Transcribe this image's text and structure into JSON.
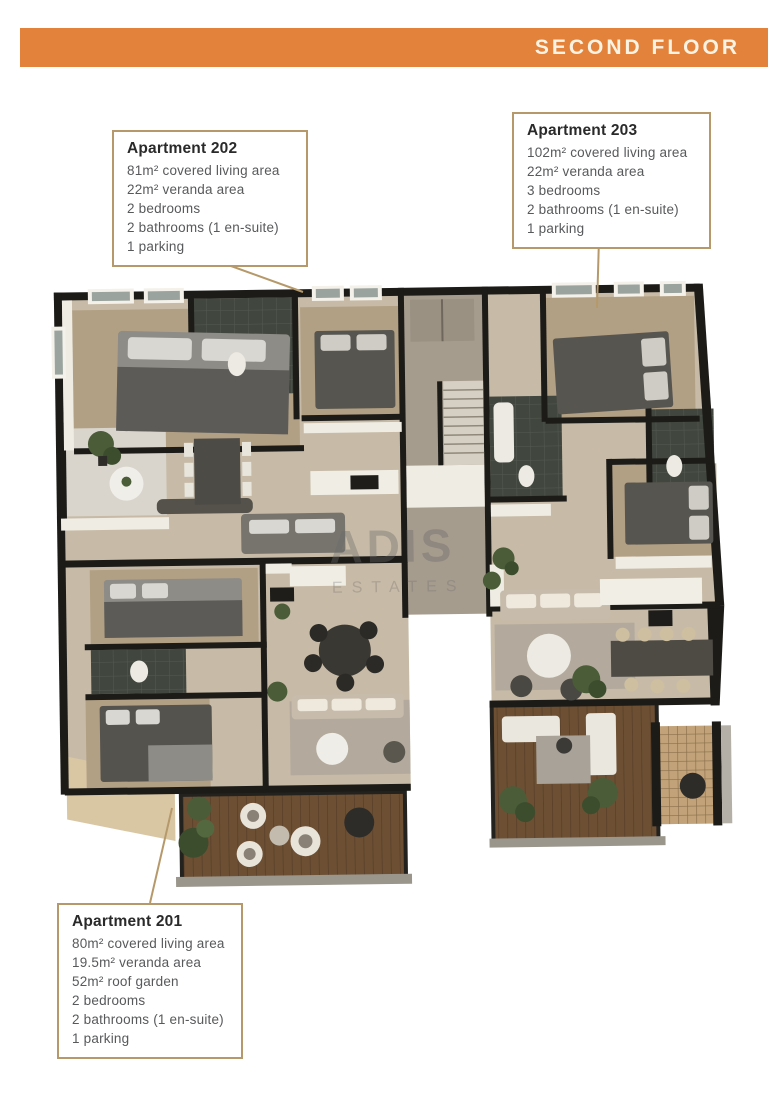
{
  "header": {
    "title": "SECOND FLOOR"
  },
  "watermark": {
    "line1": "ADIS",
    "line2": "ESTATES"
  },
  "apartments": [
    {
      "id": "202",
      "title": "Apartment 202",
      "specs": [
        "81m² covered living area",
        "22m² veranda area",
        "2 bedrooms",
        "2 bathrooms (1 en-suite)",
        "1 parking"
      ]
    },
    {
      "id": "203",
      "title": "Apartment 203",
      "specs": [
        "102m² covered living area",
        "22m² veranda area",
        "3 bedrooms",
        "2 bathrooms (1 en-suite)",
        "1 parking"
      ]
    },
    {
      "id": "201",
      "title": "Apartment 201",
      "specs": [
        "80m² covered living area",
        "19.5m² veranda area",
        "52m² roof garden",
        "2 bedrooms",
        "2 bathrooms (1 en-suite)",
        "1 parking"
      ]
    }
  ],
  "colors": {
    "accent_orange": "#e2823b",
    "header_text": "#faf3e3",
    "callout_border": "#b6996a",
    "callout_title_text": "#2a2a2a",
    "callout_body_text": "#58595b",
    "wall_dark": "#1c1b18",
    "floor_beige": "#c7bba7",
    "floor_wood": "#b2a084",
    "deck_wood": "#6d5034",
    "veranda_grey": "#d9d5cc",
    "bathroom_dark": "#41463f",
    "plant_green": "#4a5c38",
    "watermark_grey": "#6f6f6f"
  }
}
